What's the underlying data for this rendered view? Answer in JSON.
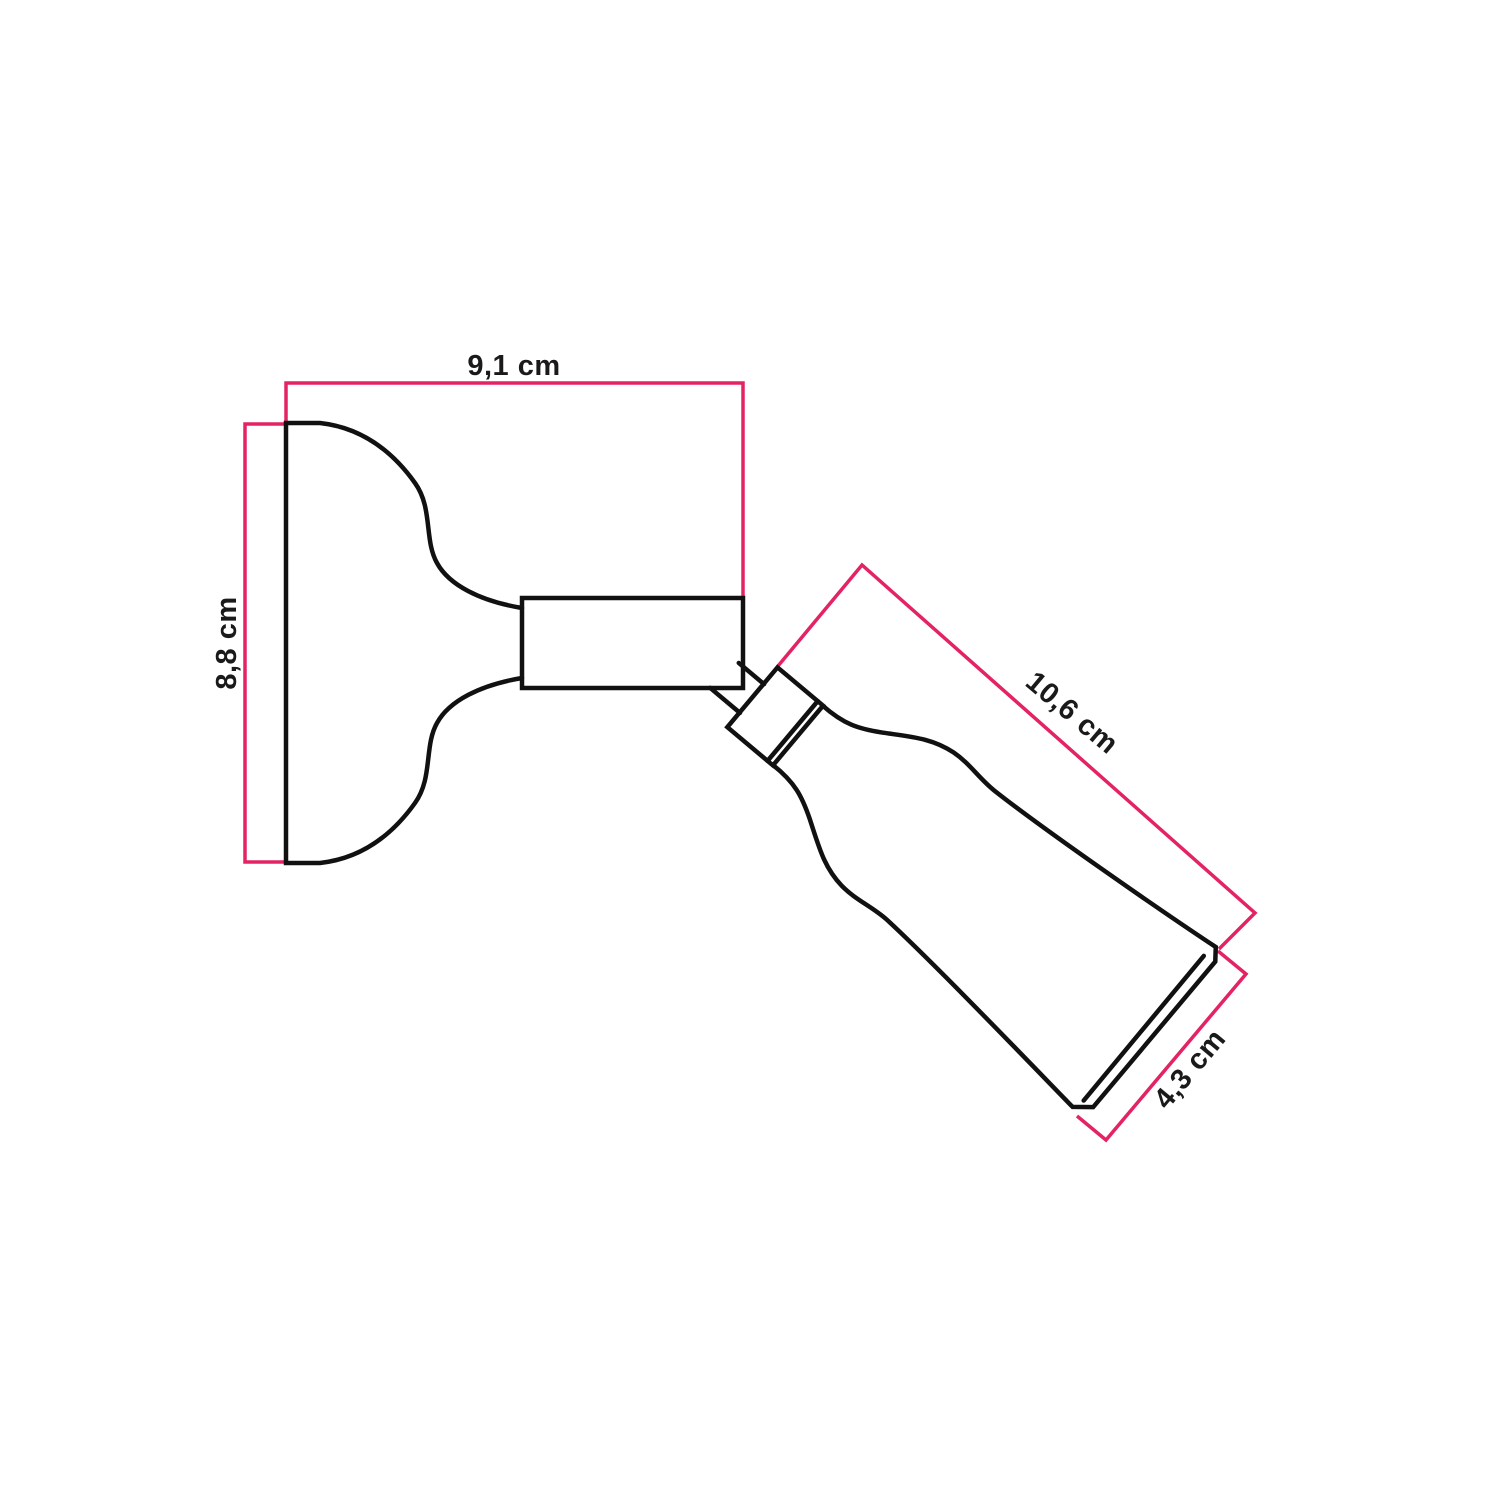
{
  "diagram": {
    "type": "product-dimension-diagram",
    "units": "cm",
    "colors": {
      "dimension": "#e32364",
      "outline": "#111111",
      "label": "#1a1a1a",
      "background": "#ffffff"
    },
    "measurements": [
      {
        "id": "base-width",
        "label": "9,1 cm"
      },
      {
        "id": "base-height",
        "label": "8,8 cm"
      },
      {
        "id": "spot-length",
        "label": "10,6 cm"
      },
      {
        "id": "spot-diameter",
        "label": "4,3 cm"
      }
    ]
  }
}
